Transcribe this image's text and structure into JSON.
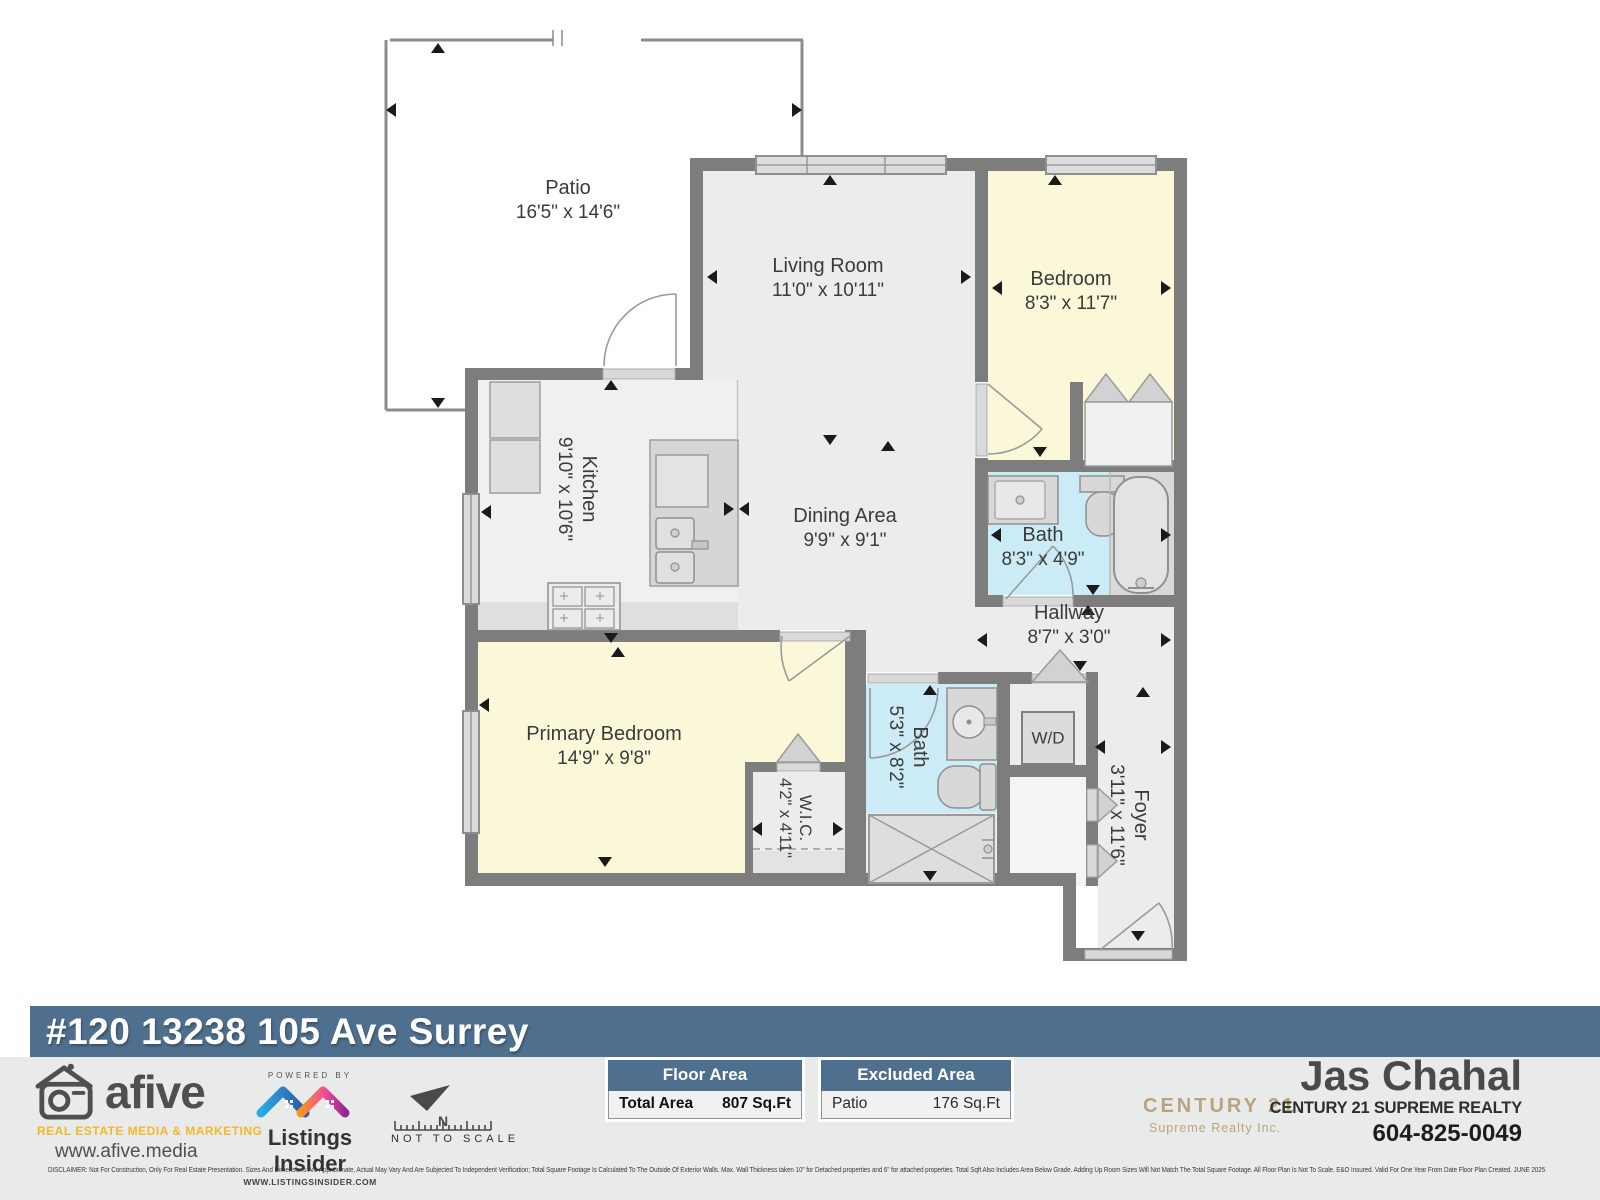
{
  "colors": {
    "banner_blue": "#4e6f8d",
    "wall_gray": "#7d7d7d",
    "floor_gray": "#ececec",
    "bedroom_yellow": "#faf8d8",
    "bath_blue": "#cbecf6",
    "century_gold": "#b9a57c",
    "afive_yellow": "#f0b92c"
  },
  "banner": {
    "address": "#120 13238 105 Ave Surrey"
  },
  "plan": {
    "rooms": [
      {
        "name": "Patio",
        "dims": "16'5\" x 14'6\""
      },
      {
        "name": "Living Room",
        "dims": "11'0\" x 10'11\""
      },
      {
        "name": "Bedroom",
        "dims": "8'3\" x 11'7\""
      },
      {
        "name": "Kitchen",
        "dims": "9'10\" x 10'6\""
      },
      {
        "name": "Dining Area",
        "dims": "9'9\" x 9'1\""
      },
      {
        "name": "Bath",
        "dims": "8'3\" x 4'9\""
      },
      {
        "name": "Hallway",
        "dims": "8'7\" x 3'0\""
      },
      {
        "name": "Primary Bedroom",
        "dims": "14'9\" x 9'8\""
      },
      {
        "name": "W.I.C.",
        "dims": "4'2\" x 4'11\""
      },
      {
        "name": "Bath",
        "dims": "5'3\" x 8'2\""
      },
      {
        "name": "W/D"
      },
      {
        "name": "Foyer",
        "dims": "3'11\" x 11'6\""
      }
    ]
  },
  "tables": {
    "floor_area": {
      "title": "Floor Area",
      "rows": [
        {
          "label": "Total Area",
          "value": "807 Sq.Ft"
        }
      ]
    },
    "excluded_area": {
      "title": "Excluded Area",
      "rows": [
        {
          "label": "Patio",
          "value": "176 Sq.Ft"
        }
      ]
    }
  },
  "branding": {
    "afive": {
      "name": "afive",
      "tagline": "REAL ESTATE MEDIA & MARKETING",
      "website": "www.afive.media"
    },
    "listings_insider": {
      "powered_by": "POWERED BY",
      "name": "Listings Insider",
      "website": "WWW.LISTINGSINSIDER.COM"
    },
    "compass": {
      "north": "N",
      "note": "NOT TO SCALE"
    },
    "century21": {
      "brand": "CENTURY 21.",
      "office": "Supreme Realty Inc."
    },
    "agent": {
      "name": "Jas Chahal",
      "company": "CENTURY 21 SUPREME REALTY",
      "phone": "604-825-0049"
    }
  },
  "disclaimer": "DISCLAIMER:  Not For Construction, Only For Real Estate Presentation. Sizes And Dimensions Are Approximate, Actual May Vary And Are Subjected To Independent Verification; Total Square Footage Is Calculated To The Outside Of Exterior Walls.  Max. Wall Thickness taken 10\" for Detached properties and 6\" for attached properties. Total Sqft Also Includes Area Below Grade. Adding Up Room Sizes Will Not Match The Total Square Footage. All Floor Plan Is Not To Scale. E&O Insured.  Valid For One Year From Date Floor Plan Created. JUNE 2025"
}
